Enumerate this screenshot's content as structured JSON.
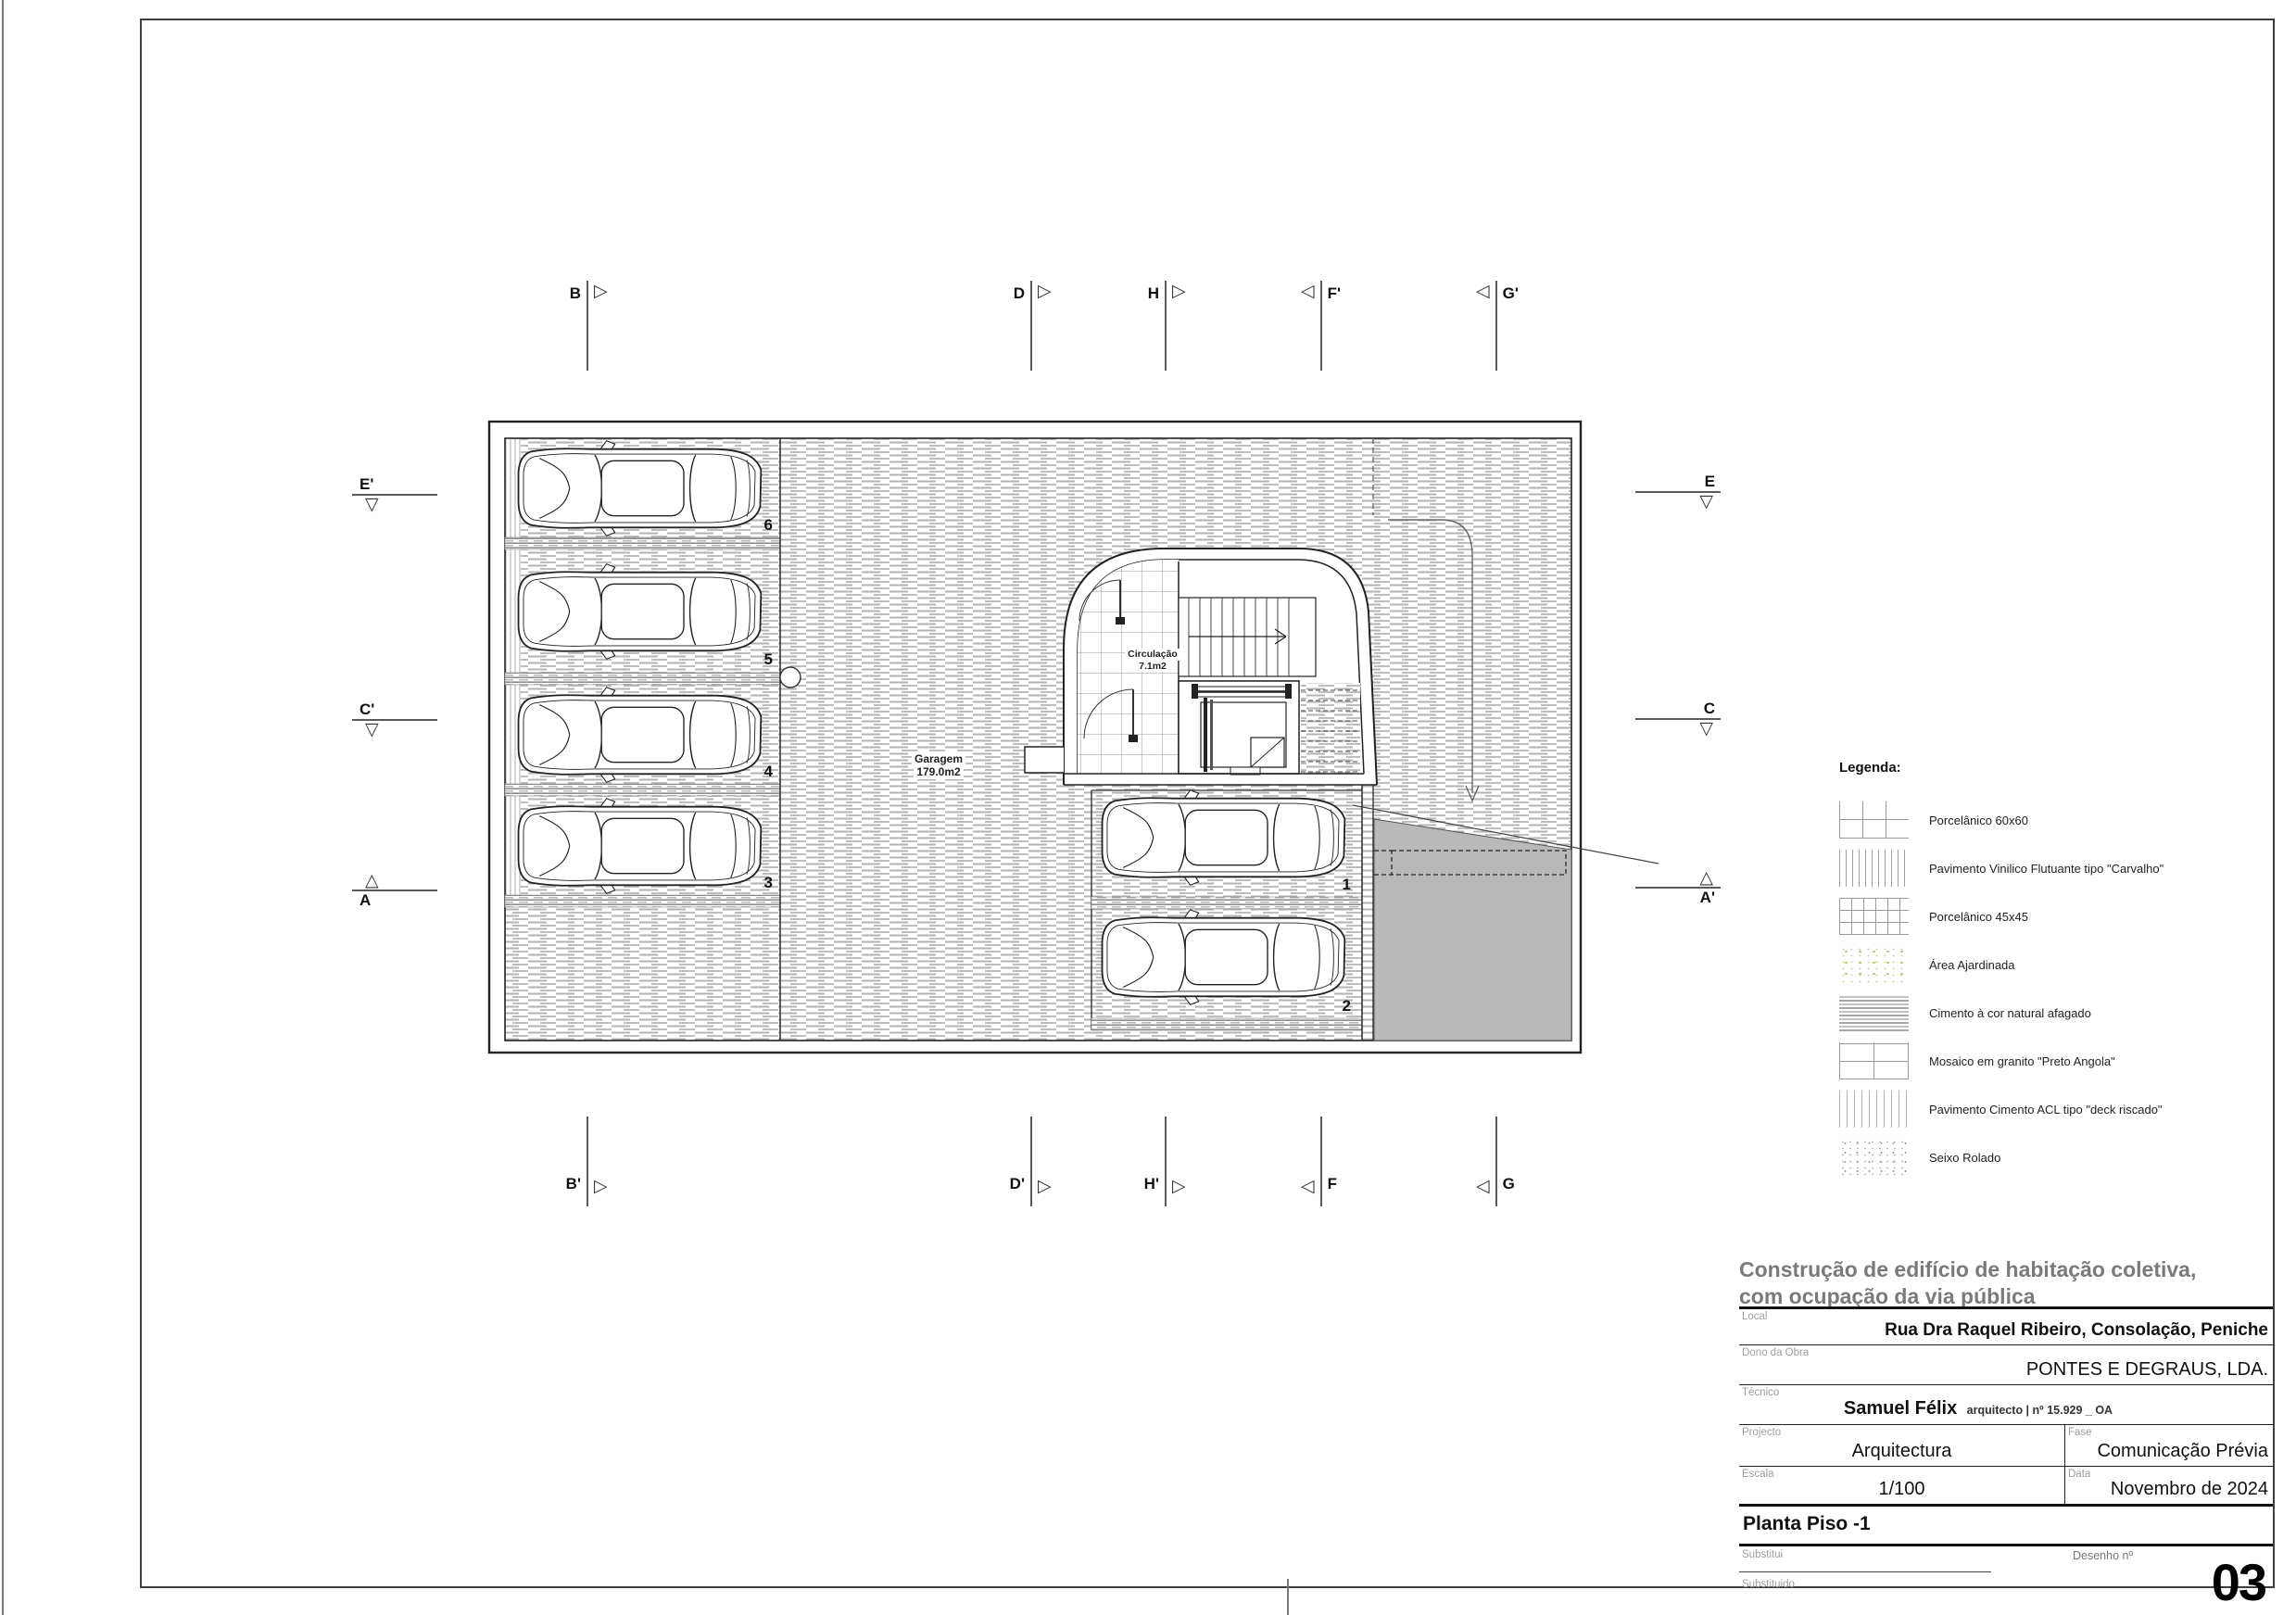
{
  "plan": {
    "garage_label": {
      "name": "Garagem",
      "area": "179.0m2"
    },
    "circulation_label": {
      "name": "Circulação",
      "area": "7.1m2"
    },
    "stall_numbers": {
      "s1": "1",
      "s2": "2",
      "s3": "3",
      "s4": "4",
      "s5": "5",
      "s6": "6"
    },
    "markers": {
      "b": "B",
      "d": "D",
      "h": "H",
      "f_prime": "F'",
      "g_prime": "G'",
      "b_prime": "B'",
      "d_prime": "D'",
      "h_prime": "H'",
      "f": "F",
      "g": "G",
      "e_prime": "E'",
      "c_prime": "C'",
      "a": "A",
      "e": "E",
      "c": "C",
      "a_prime": "A'"
    },
    "icons": {
      "tri_right": "▷",
      "tri_left": "◁",
      "tri_up": "△",
      "tri_down": "▽"
    }
  },
  "legend": {
    "title": "Legenda:",
    "items": [
      {
        "label": "Porcelânico 60x60",
        "pattern": "grid-60"
      },
      {
        "label": "Pavimento Vinilico Flutuante tipo \"Carvalho\"",
        "pattern": "vertical-lines-dense"
      },
      {
        "label": "Porcelânico 45x45",
        "pattern": "grid-45"
      },
      {
        "label": "Área Ajardinada",
        "pattern": "garden-dots"
      },
      {
        "label": "Cimento à cor natural afagado",
        "pattern": "cement-stripes"
      },
      {
        "label": "Mosaico em granito \"Preto Angola\"",
        "pattern": "granite-brick"
      },
      {
        "label": "Pavimento Cimento ACL tipo \"deck riscado\"",
        "pattern": "deck-lines"
      },
      {
        "label": "Seixo Rolado",
        "pattern": "pebbles"
      }
    ]
  },
  "title_block": {
    "title_line1": "Construção de edifício de habitação coletiva,",
    "title_line2": "com ocupação da via pública",
    "local_label": "Local",
    "local_value": "Rua Dra Raquel Ribeiro, Consolação, Peniche",
    "owner_label": "Dono da Obra",
    "owner_value": "PONTES E DEGRAUS, LDA.",
    "technician_label": "Técnico",
    "technician_name": "Samuel Félix",
    "technician_credentials": "arquitecto | nº 15.929 _ OA",
    "project_label": "Projecto",
    "project_value": "Arquitectura",
    "phase_label": "Fase",
    "phase_value": "Comunicação Prévia",
    "scale_label": "Escala",
    "scale_value": "1/100",
    "date_label": "Data",
    "date_value": "Novembro de 2024",
    "sheet_title": "Planta Piso -1",
    "replaces_label": "Substitui",
    "replaced_label": "Substituido",
    "drawing_number_label": "Desenho nº",
    "drawing_number": "03"
  }
}
